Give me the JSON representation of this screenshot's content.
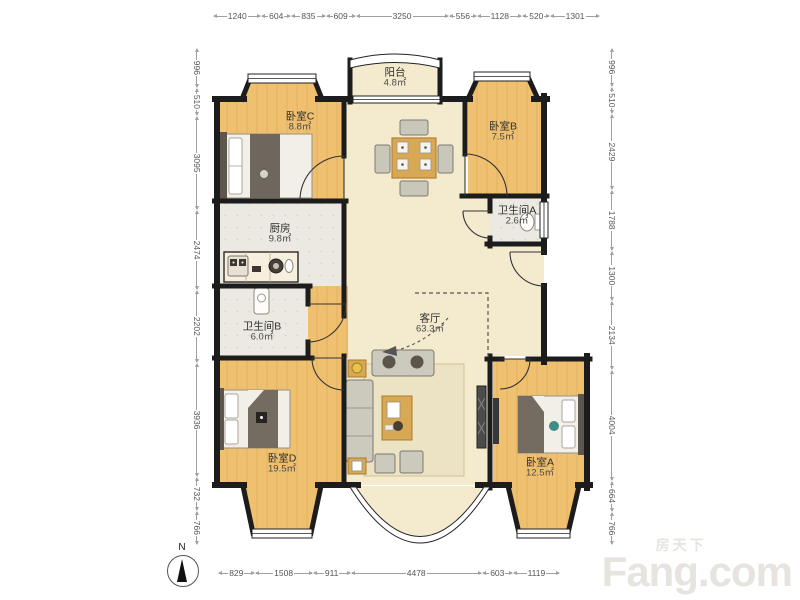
{
  "rulers": {
    "top": [
      "1240",
      "604",
      "835",
      "609",
      "3250",
      "556",
      "1128",
      "520",
      "1301"
    ],
    "bottom": [
      "829",
      "1508",
      "911",
      "4478",
      "603",
      "1119"
    ],
    "left": [
      "996",
      "510",
      "3095",
      "2474",
      "2202",
      "3936",
      "732",
      "766"
    ],
    "right": [
      "996",
      "510",
      "2429",
      "1788",
      "1300",
      "2134",
      "4004",
      "664",
      "766"
    ]
  },
  "rooms": {
    "balcony": {
      "name": "阳台",
      "area": "4.8㎡"
    },
    "bedroom_c": {
      "name": "卧室C",
      "area": "8.8㎡"
    },
    "bedroom_b": {
      "name": "卧室B",
      "area": "7.5㎡"
    },
    "bathroom_a": {
      "name": "卫生间A",
      "area": "2.6㎡"
    },
    "kitchen": {
      "name": "厨房",
      "area": "9.8㎡"
    },
    "bathroom_b": {
      "name": "卫生间B",
      "area": "6.0㎡"
    },
    "living_room": {
      "name": "客厅",
      "area": "63.3㎡"
    },
    "bedroom_d": {
      "name": "卧室D",
      "area": "19.5㎡"
    },
    "bedroom_a": {
      "name": "卧室A",
      "area": "12.5㎡"
    }
  },
  "compass": {
    "label": "N"
  },
  "watermark": {
    "cn": "房天下",
    "en": "Fang.com"
  },
  "colors": {
    "wall": "#1c1c1c",
    "wood": "#eec06f",
    "tile": "#ebe9e2",
    "living": "#f4ebce"
  }
}
